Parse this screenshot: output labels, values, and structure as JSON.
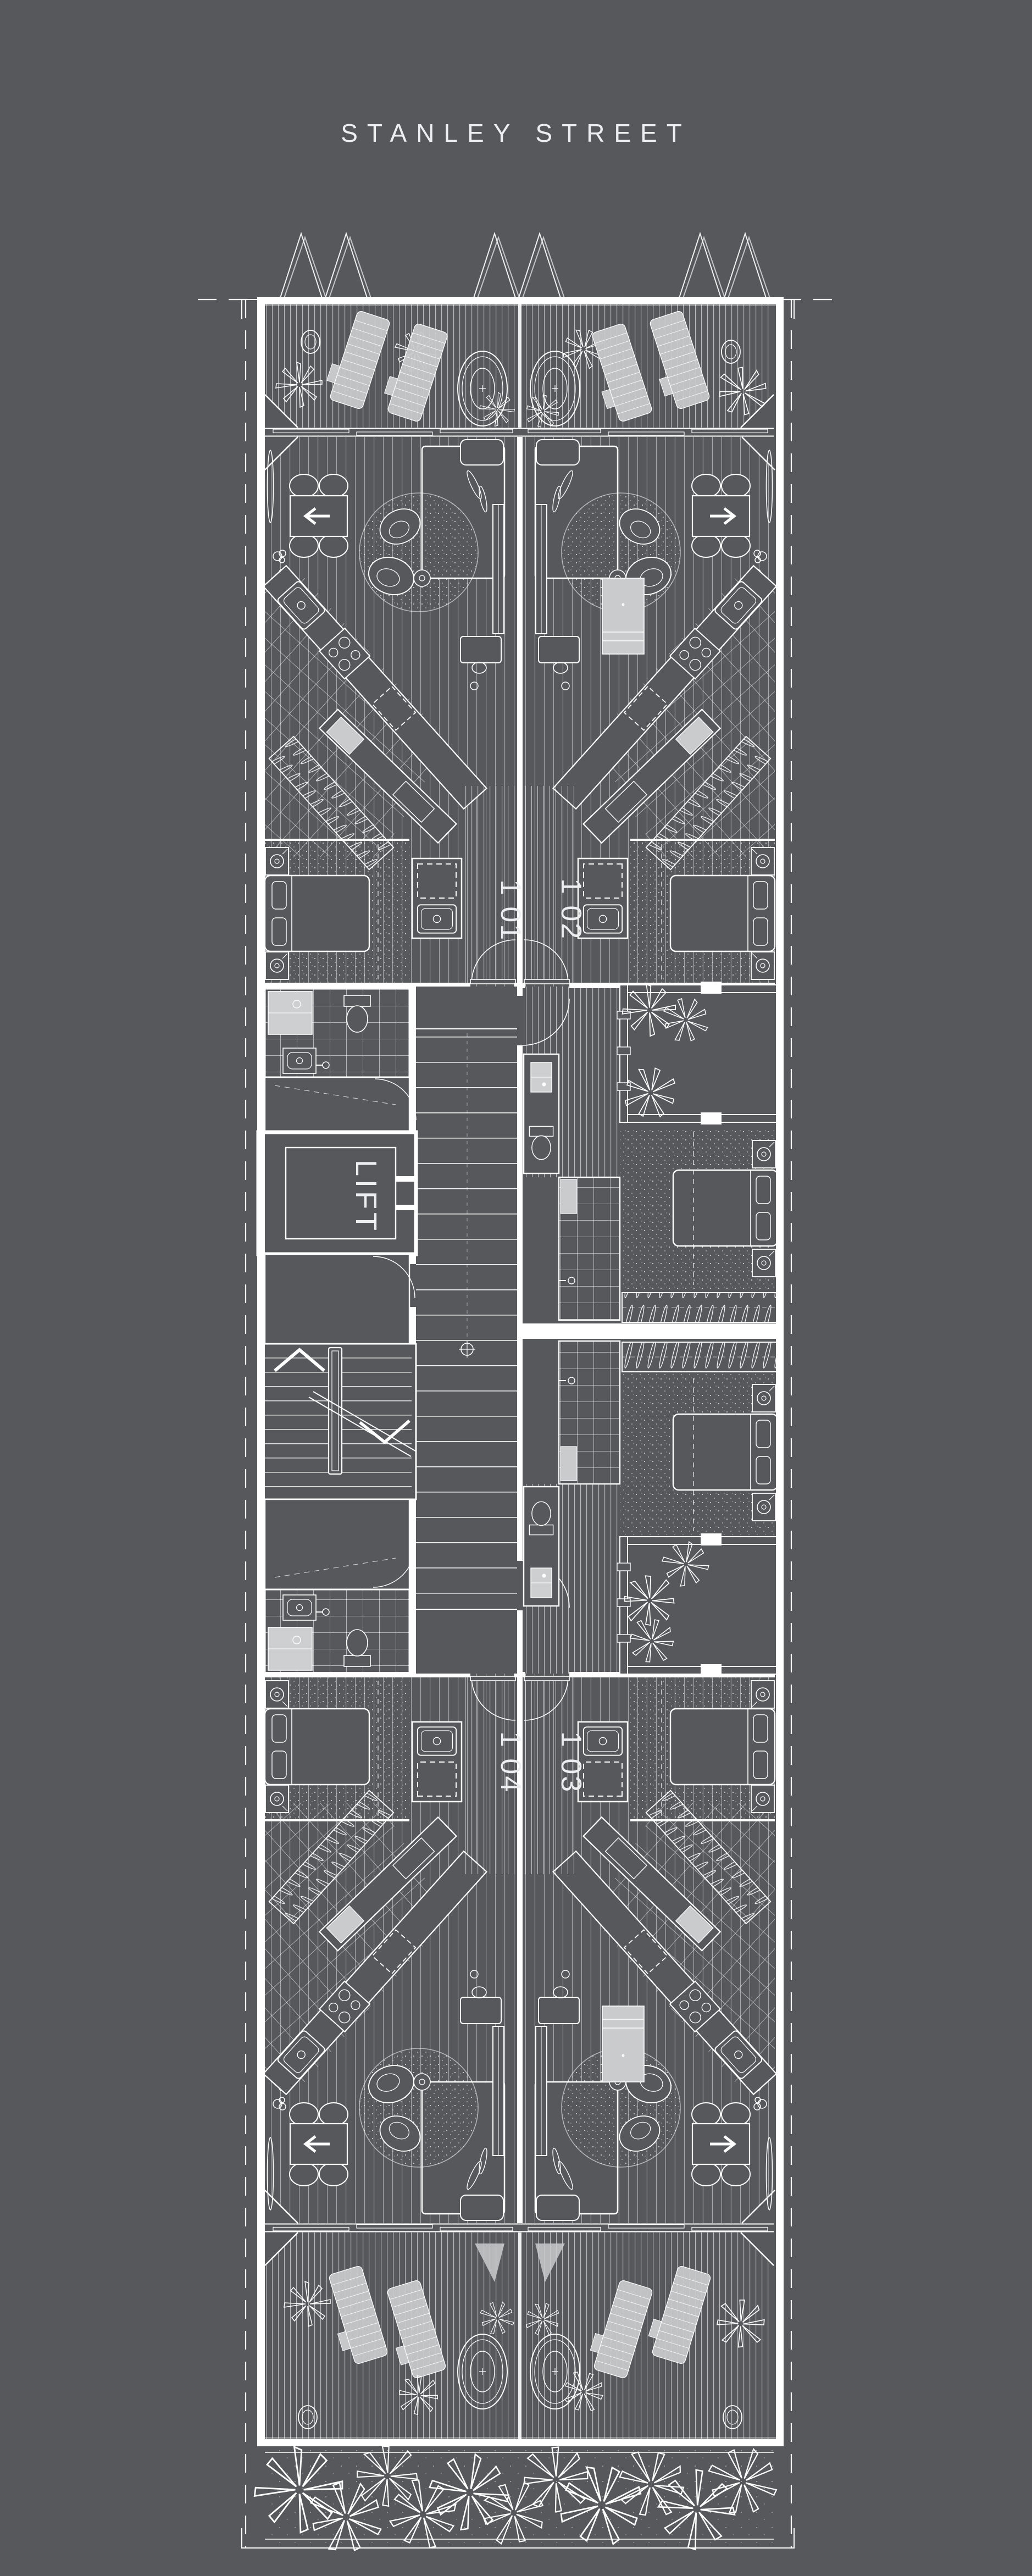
{
  "colors": {
    "background": "#56585B",
    "linework": "#FFFFFF",
    "furniture_light": "#C9CBCD",
    "label_text": "#EDEEEF"
  },
  "title": {
    "text": "STANLEY STREET"
  },
  "core": {
    "lift_label": "LIFT"
  },
  "units": [
    {
      "id": "101",
      "label": "1 01"
    },
    {
      "id": "102",
      "label": "1 02"
    },
    {
      "id": "103",
      "label": "1 03"
    },
    {
      "id": "104",
      "label": "1 04"
    }
  ]
}
